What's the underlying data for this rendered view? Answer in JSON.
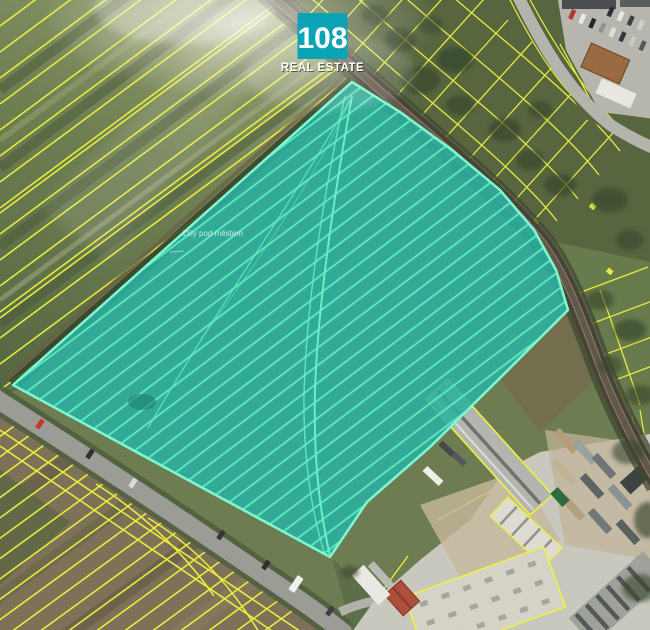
{
  "logo": {
    "number": "108",
    "caption": "REAL ESTATE"
  },
  "map": {
    "place_label": "Díly pod městem",
    "highlighted_parcel_name": "highlighted sale parcel"
  },
  "colors": {
    "brand_teal": "#0ba4b6",
    "parcel_fill": "#2bb1a0",
    "parcel_stripe": "#5cedc1",
    "parcel_outline": "#7ff7d1",
    "cadastral_yellow": "#eef23f",
    "railway_dark": "#4a4236",
    "road_grey": "#9c9c96",
    "label_text": "#d5efe3",
    "logo_text": "#ffffff"
  }
}
